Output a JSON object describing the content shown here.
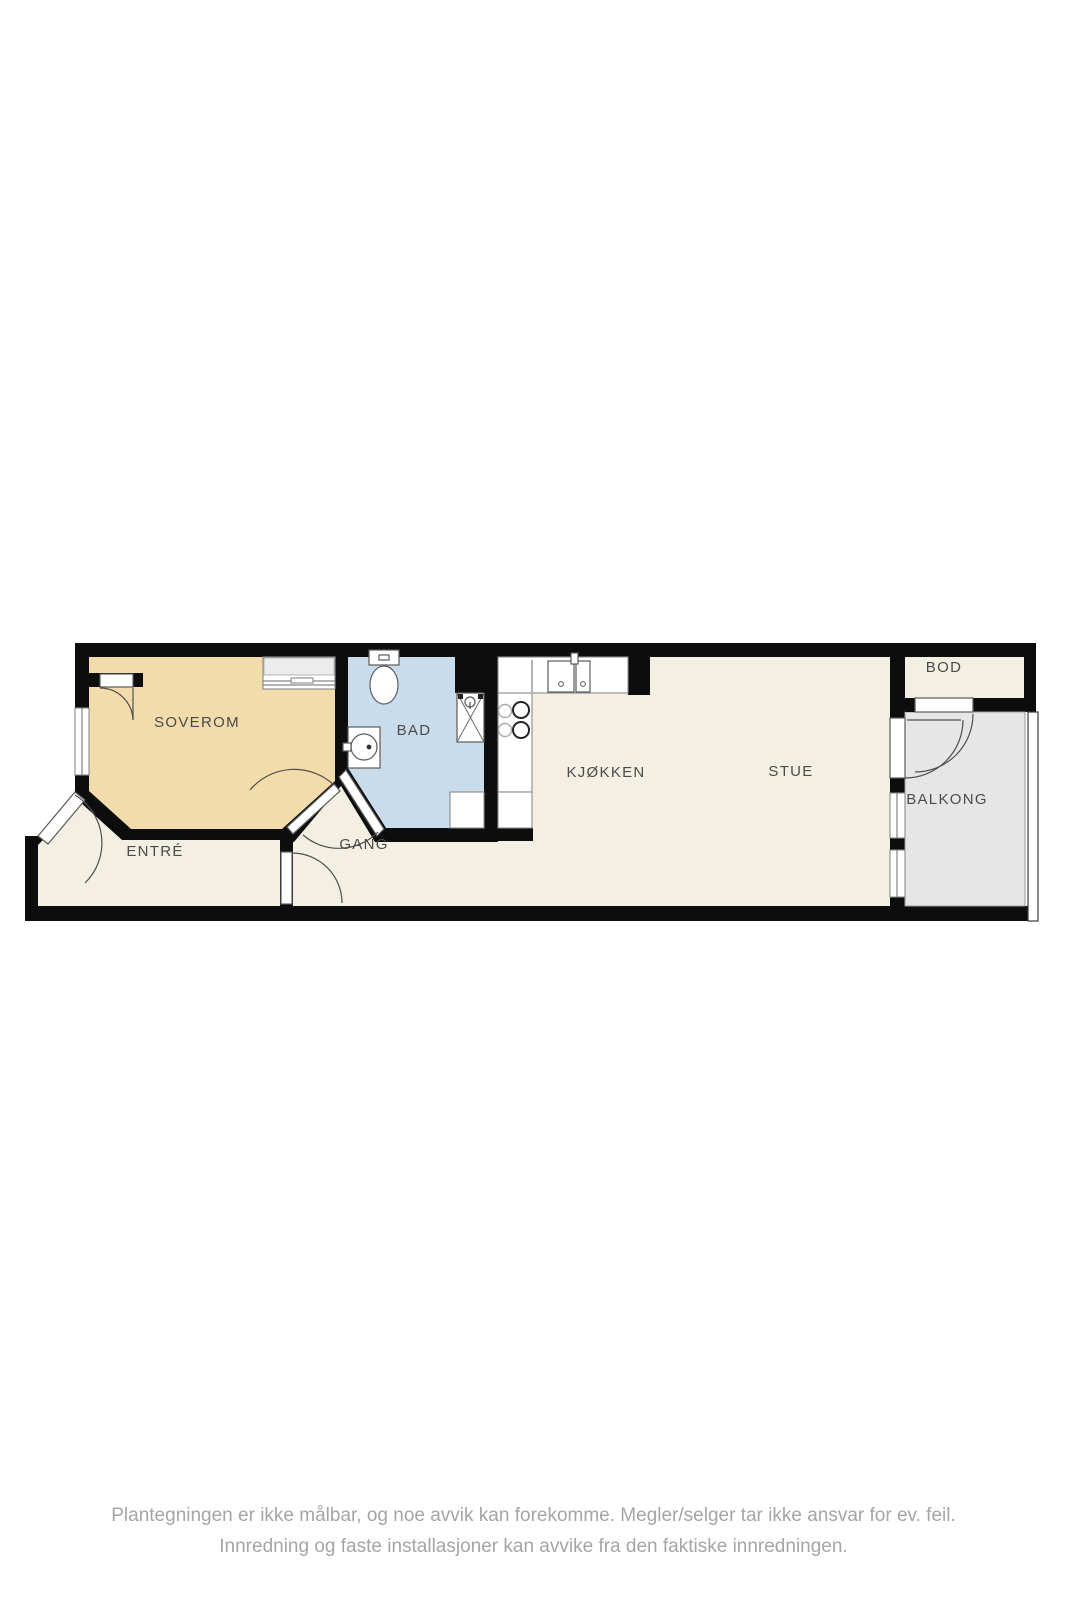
{
  "rooms": {
    "soverom": {
      "label": "SOVEROM"
    },
    "bad": {
      "label": "BAD"
    },
    "entre": {
      "label": "ENTRÉ"
    },
    "gang": {
      "label": "GANG"
    },
    "kjokken": {
      "label": "KJØKKEN"
    },
    "stue": {
      "label": "STUE"
    },
    "bod": {
      "label": "BOD"
    },
    "balkong": {
      "label": "BALKONG"
    }
  },
  "disclaimer": {
    "line1": "Plantegningen er ikke målbar, og noe avvik kan forekomme. Megler/selger tar ikke ansvar for ev. feil.",
    "line2": "Innredning og faste installasjoner kan avvike fra den faktiske innredningen."
  },
  "colors": {
    "wall": "#0d0d0d",
    "floor": "#f4efe3",
    "bedroom": "#f3dcab",
    "bathroom": "#c9dcec",
    "balcony": "#e6e6e6",
    "label_text": "#4b4b4b",
    "disclaimer_text": "#a5a5a3"
  }
}
